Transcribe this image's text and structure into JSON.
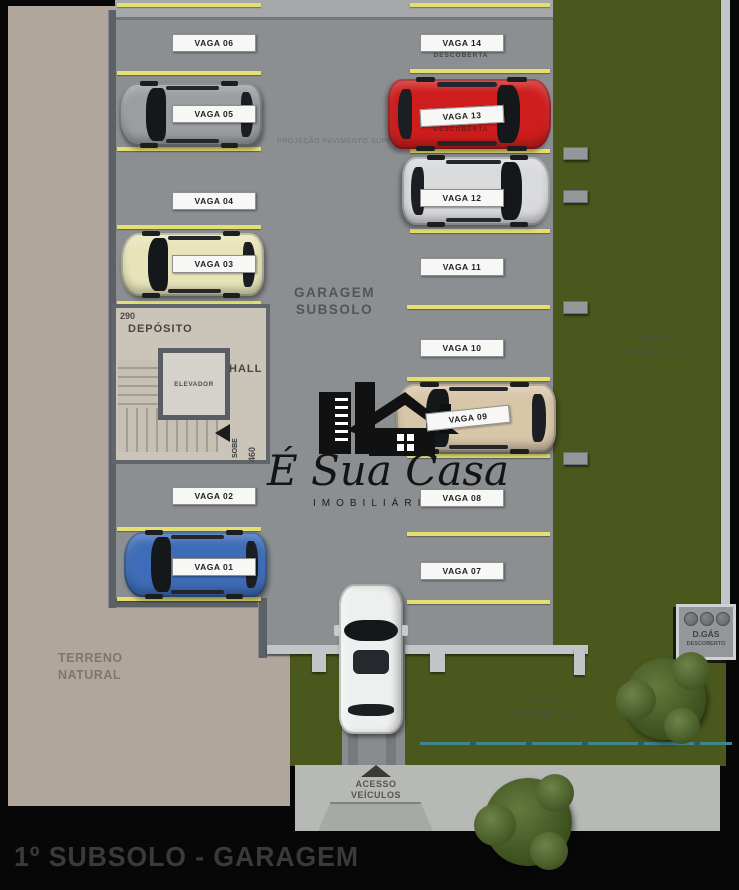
{
  "page": {
    "title": "1º SUBSOLO - GARAGEM"
  },
  "brand": {
    "name": "É Sua Casa",
    "subtitle": "IMOBILIÁRIA"
  },
  "garage": {
    "name_line1": "GARAGEM",
    "name_line2": "SUBSOLO",
    "projection_note": "PROJEÇÃO PAVIMENTO SUPERIOR"
  },
  "core": {
    "dim_top": "290",
    "dim_side": "460",
    "depot_label": "DEPÓSITO",
    "elevator_label": "ELEVADOR",
    "hall_label": "HALL",
    "stairs_label": "SOBE"
  },
  "spots": [
    {
      "label": "VAGA 01"
    },
    {
      "label": "VAGA 02"
    },
    {
      "label": "VAGA 03"
    },
    {
      "label": "VAGA 04"
    },
    {
      "label": "VAGA 05"
    },
    {
      "label": "VAGA 06"
    },
    {
      "label": "VAGA 07"
    },
    {
      "label": "VAGA 08"
    },
    {
      "label": "VAGA 09"
    },
    {
      "label": "VAGA 10"
    },
    {
      "label": "VAGA 11"
    },
    {
      "label": "VAGA 12"
    },
    {
      "label": "VAGA 13",
      "note": "DESCOBERTA"
    },
    {
      "label": "VAGA 14",
      "note": "DESCOBERTA"
    }
  ],
  "site": {
    "terrain_line1": "TERRENO",
    "terrain_line2": "NATURAL",
    "permeable_line1": "ÁREA",
    "permeable_line2": "PERMEÁVEL",
    "access_line1": "ACESSO",
    "access_line2": "VEÍCULOS",
    "gas_label": "D.GÁS",
    "gas_note": "DESCOBERTO"
  },
  "colors": {
    "line_yellow": "#e3e06f",
    "grass_green": "#4a581d",
    "floor_gray": "#8c8f92",
    "terrain_beige": "#b1a69b",
    "fence_teal": "#3f868c",
    "car_red": "#cf1d1d",
    "car_blue": "#3e6cb8",
    "car_cream": "#e8e4ba",
    "car_gray": "#9b9ea1",
    "car_silver": "#d9dadc",
    "car_champagne": "#d8c6a9",
    "car_white": "#eef0ef"
  }
}
